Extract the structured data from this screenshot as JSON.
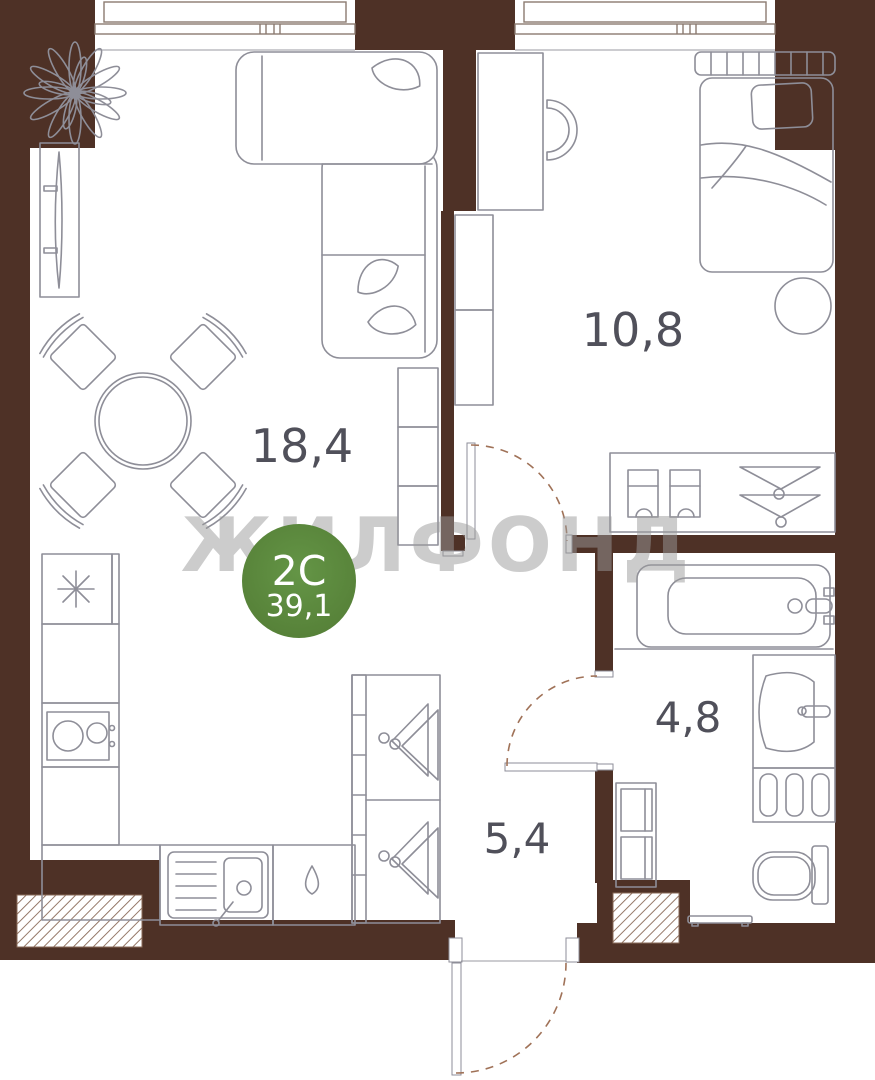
{
  "plan": {
    "watermark": "ЖИЛФОНД",
    "badge": {
      "type": "2С",
      "area": "39,1"
    },
    "rooms": {
      "living_kitchen": {
        "area_label": "18,4"
      },
      "bedroom": {
        "area_label": "10,8"
      },
      "bathroom": {
        "area_label": "4,8"
      },
      "hallway": {
        "area_label": "5,4"
      }
    },
    "colors": {
      "wall_brown": "#4E3126",
      "furniture_line_gray": "#8E8E98",
      "label_gray": "#50505A",
      "badge_green": "#5B893D",
      "watermark_gray": "#C2C2C2",
      "door_arc_brown": "#A07258"
    }
  }
}
